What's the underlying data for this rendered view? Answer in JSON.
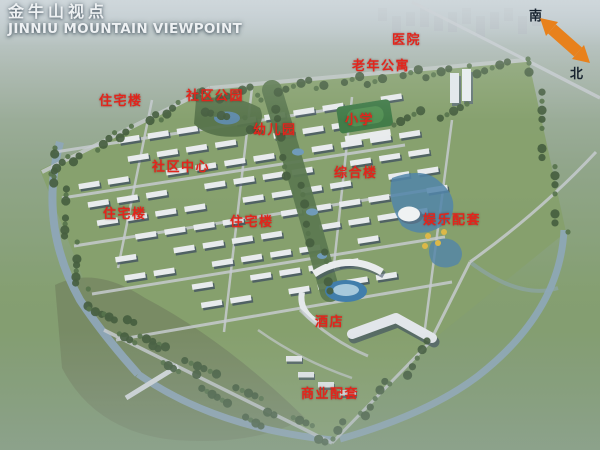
{
  "title": {
    "zh": "金牛山视点",
    "en": "JINNIU MOUNTAIN VIEWPOINT"
  },
  "compass": {
    "south": "南",
    "north": "北"
  },
  "map_labels": [
    {
      "text": "医院",
      "x": 392,
      "y": 29
    },
    {
      "text": "老年公寓",
      "x": 352,
      "y": 55
    },
    {
      "text": "住宅楼",
      "x": 99,
      "y": 90
    },
    {
      "text": "社区公园",
      "x": 186,
      "y": 85
    },
    {
      "text": "幼儿园",
      "x": 253,
      "y": 119
    },
    {
      "text": "小学",
      "x": 345,
      "y": 109
    },
    {
      "text": "社区中心",
      "x": 152,
      "y": 156
    },
    {
      "text": "综合楼",
      "x": 334,
      "y": 162
    },
    {
      "text": "住宅楼",
      "x": 103,
      "y": 203
    },
    {
      "text": "住宅楼",
      "x": 230,
      "y": 211
    },
    {
      "text": "娱乐配套",
      "x": 423,
      "y": 209
    },
    {
      "text": "酒店",
      "x": 315,
      "y": 311
    },
    {
      "text": "商业配套",
      "x": 301,
      "y": 383
    }
  ],
  "colors": {
    "label_red": "#e2251c",
    "arrow_orange": "#e8811c",
    "title_white": "#eef1f3",
    "compass_ink": "#17232f"
  }
}
